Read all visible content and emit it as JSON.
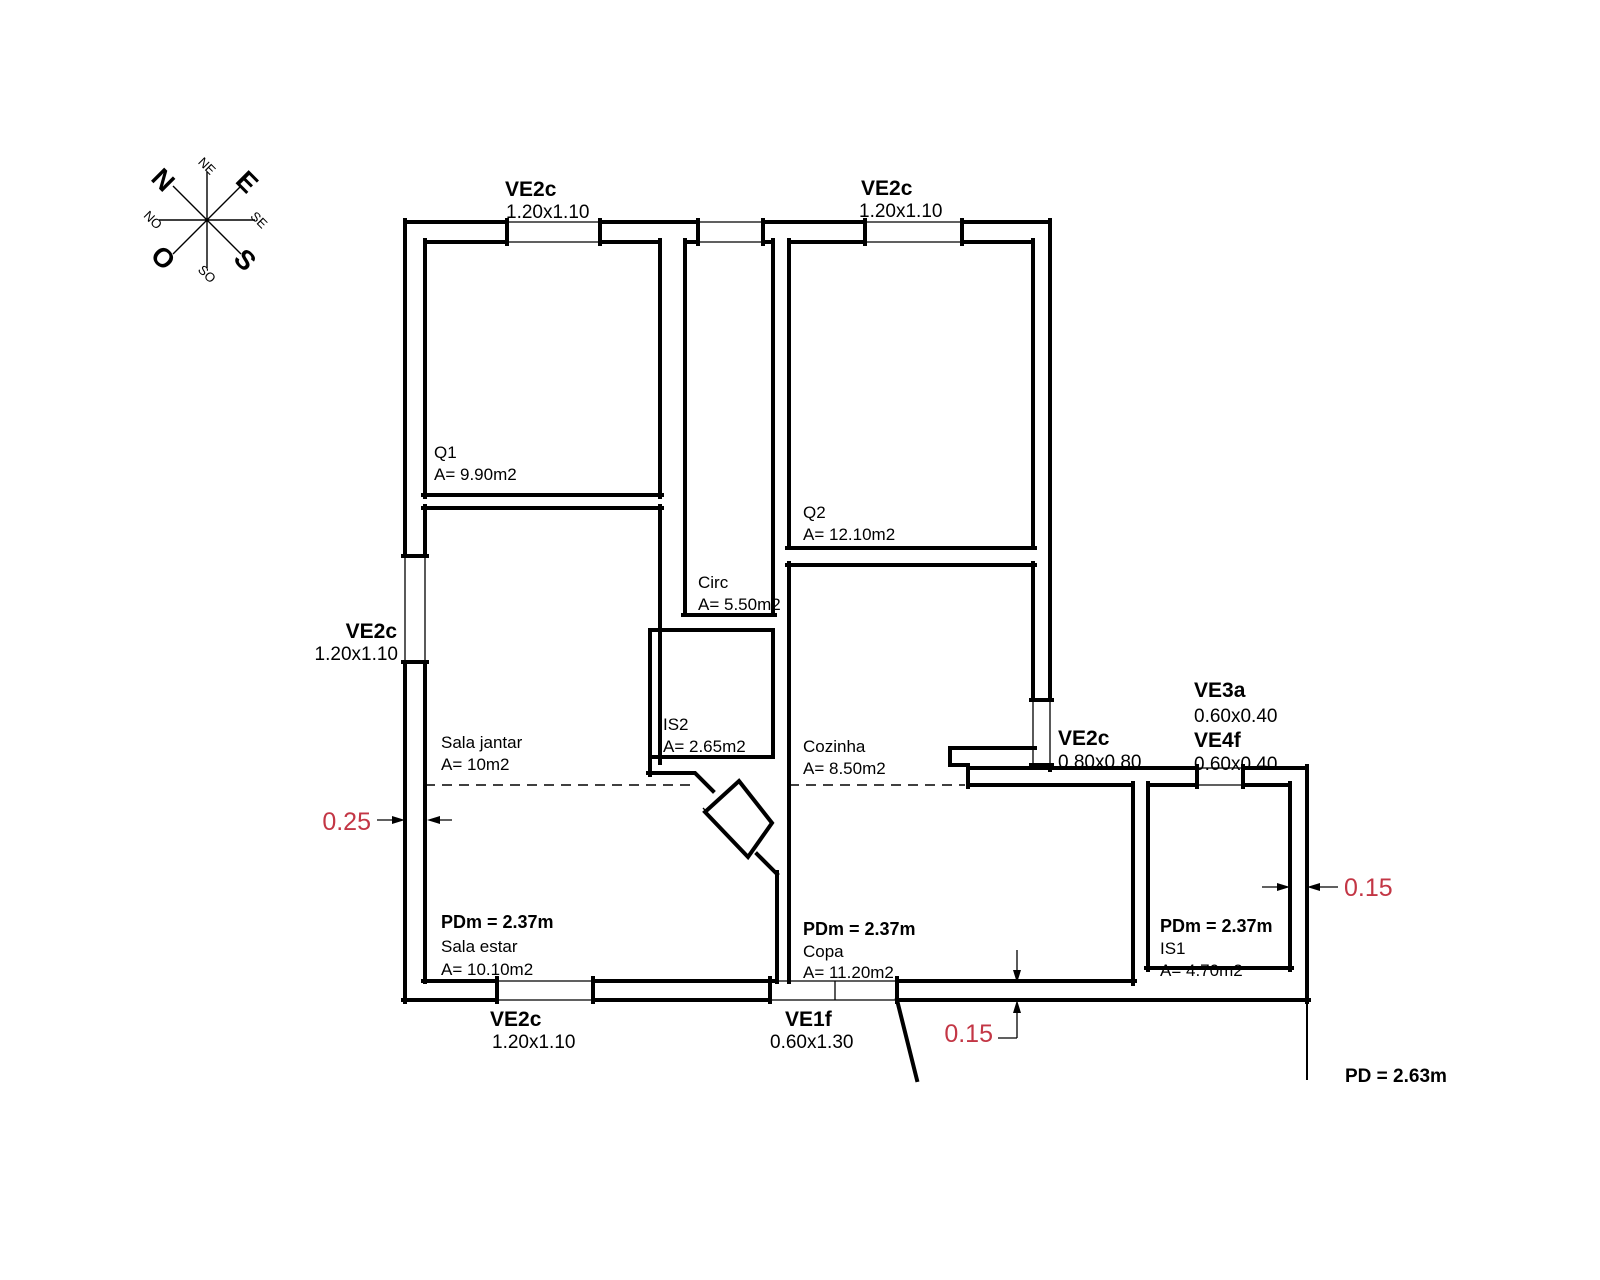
{
  "compass": {
    "n": "N",
    "e": "E",
    "s": "S",
    "o": "O",
    "ne": "NE",
    "se": "SE",
    "so": "SO",
    "no": "NO"
  },
  "windows": {
    "top_left": {
      "code": "VE2c",
      "size": "1.20x1.10"
    },
    "top_right": {
      "code": "VE2c",
      "size": "1.20x1.10"
    },
    "left": {
      "code": "VE2c",
      "size": "1.20x1.10"
    },
    "bottom": {
      "code": "VE2c",
      "size": "1.20x1.10"
    },
    "bottom_door": {
      "code": "VE1f",
      "size": "0.60x1.30"
    },
    "right": {
      "code": "VE2c",
      "size": "0.80x0.80"
    },
    "ve3a": {
      "code": "VE3a",
      "size": "0.60x0.40"
    },
    "ve4f": {
      "code": "VE4f",
      "size": "0.60x0.40"
    }
  },
  "rooms": {
    "q1": {
      "name": "Q1",
      "area": "A= 9.90m2"
    },
    "q2": {
      "name": "Q2",
      "area": "A= 12.10m2"
    },
    "circ": {
      "name": "Circ",
      "area": "A= 5.50m2"
    },
    "is2": {
      "name": "IS2",
      "area": "A= 2.65m2"
    },
    "cozinha": {
      "name": "Cozinha",
      "area": "A= 8.50m2"
    },
    "sala_jantar": {
      "name": "Sala jantar",
      "area": "A= 10m2"
    },
    "sala_estar": {
      "ceiling": "PDm = 2.37m",
      "name": "Sala estar",
      "area": "A= 10.10m2"
    },
    "copa": {
      "ceiling": "PDm = 2.37m",
      "name": "Copa",
      "area": "A= 11.20m2"
    },
    "is1": {
      "ceiling": "PDm = 2.37m",
      "name": "IS1",
      "area": "A= 4.70m2"
    }
  },
  "dimensions": {
    "left_wall": "0.25",
    "bottom_wall": "0.15",
    "right_wall": "0.15",
    "ceiling_total": "PD = 2.63m"
  },
  "colors": {
    "line": "#000000",
    "dimension_red": "#c33645"
  }
}
